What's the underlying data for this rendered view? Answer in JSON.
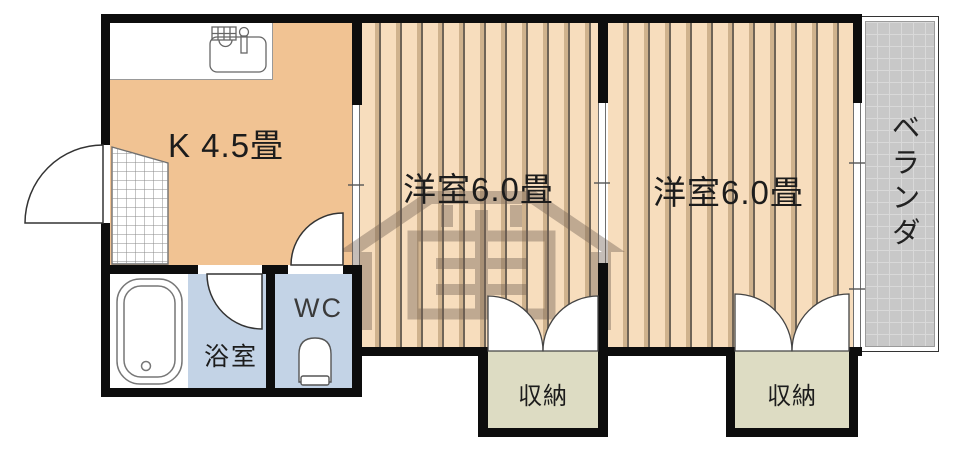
{
  "title": "apartment-floor-plan",
  "rooms": {
    "kitchen": {
      "label": "K 4.5畳"
    },
    "western_room_1": {
      "label": "洋室6.0畳"
    },
    "western_room_2": {
      "label": "洋室6.0畳"
    },
    "bathroom": {
      "label": "浴室"
    },
    "toilet": {
      "label": "WC"
    },
    "storage_1": {
      "label": "収納"
    },
    "storage_2": {
      "label": "収納"
    },
    "veranda": {
      "label": "ベランダ"
    }
  },
  "icons": {
    "kitchen_sink": "kitchen-sink-icon",
    "bathtub": "bathtub-icon",
    "toilet": "toilet-icon",
    "entrance_door": "entrance-door-arc",
    "bathroom_door": "bathroom-door-arc",
    "wc_door": "wc-door-arc",
    "closet_doors": "closet-double-door-arcs",
    "watermark": "watermark-logo"
  },
  "colors": {
    "wall": "#0d0d0d",
    "kitchen_fill": "#f1c393",
    "room_fill": "#f7ddbd",
    "stripe_shade": "#cfb28d",
    "stripe_line": "#6f6457",
    "wet_fill": "#c3d3e6",
    "storage_fill": "#dddcc3",
    "veranda_fill": "#c8c8c8",
    "veranda_grid": "#d9d9d9",
    "label_color": "#1c1c1c",
    "watermark_color": "#6e5c50"
  }
}
